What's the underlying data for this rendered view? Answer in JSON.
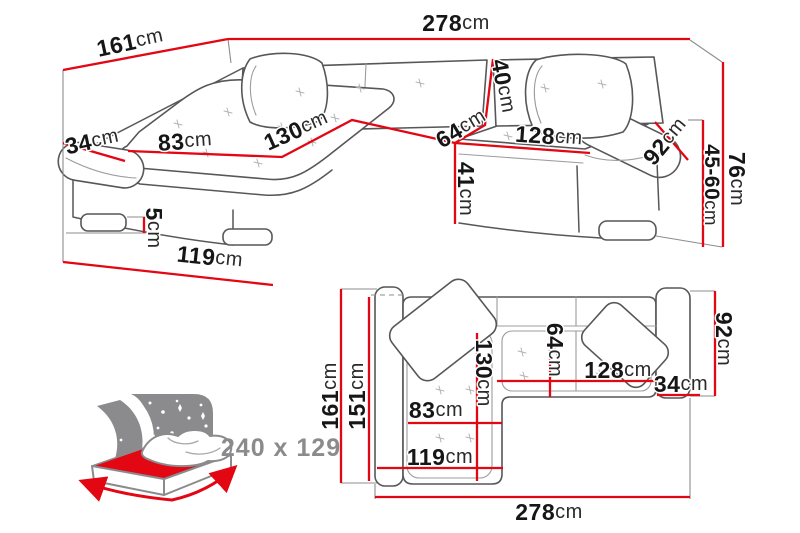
{
  "colors": {
    "dimension_red": "#e30613",
    "outline_gray": "#57575a",
    "soft_gray": "#9c9c9e",
    "icon_gray": "#8b8b8d",
    "text_ink": "#161616",
    "background": "#ffffff"
  },
  "perspective_view": {
    "labels": {
      "length_left": {
        "v": "161",
        "u": "cm"
      },
      "length_total": {
        "v": "278",
        "u": "cm"
      },
      "arm_width_left": {
        "v": "34",
        "u": "cm"
      },
      "chaise_seat_width": {
        "v": "83",
        "u": "cm"
      },
      "chaise_seat_length": {
        "v": "130",
        "u": "cm"
      },
      "backrest_height": {
        "v": "40",
        "u": "cm"
      },
      "corner_seat": {
        "v": "64",
        "u": "cm"
      },
      "seat_length_right": {
        "v": "128",
        "u": "cm"
      },
      "arm_width_right": {
        "v": "92",
        "u": "cm"
      },
      "seat_front_height": {
        "v": "41",
        "u": "cm"
      },
      "leg_height": {
        "v": "5",
        "u": "cm"
      },
      "seat_height_range": {
        "v": "45-60",
        "u": "cm"
      },
      "total_height": {
        "v": "76",
        "u": "cm"
      },
      "chaise_depth": {
        "v": "119",
        "u": "cm"
      }
    }
  },
  "plan_view": {
    "labels": {
      "depth_total": {
        "v": "161",
        "u": "cm"
      },
      "depth_inner": {
        "v": "151",
        "u": "cm"
      },
      "chaise_length": {
        "v": "130",
        "u": "cm"
      },
      "corner_seat": {
        "v": "64",
        "u": "cm"
      },
      "chaise_seat_width": {
        "v": "83",
        "u": "cm"
      },
      "chaise_width": {
        "v": "119",
        "u": "cm"
      },
      "seat_length_right": {
        "v": "128",
        "u": "cm"
      },
      "arm_width_right": {
        "v": "34",
        "u": "cm"
      },
      "depth_right": {
        "v": "92",
        "u": "cm"
      },
      "width_total": {
        "v": "278",
        "u": "cm"
      }
    }
  },
  "bed_icon": {
    "sleeping_area": "240 x 129"
  }
}
